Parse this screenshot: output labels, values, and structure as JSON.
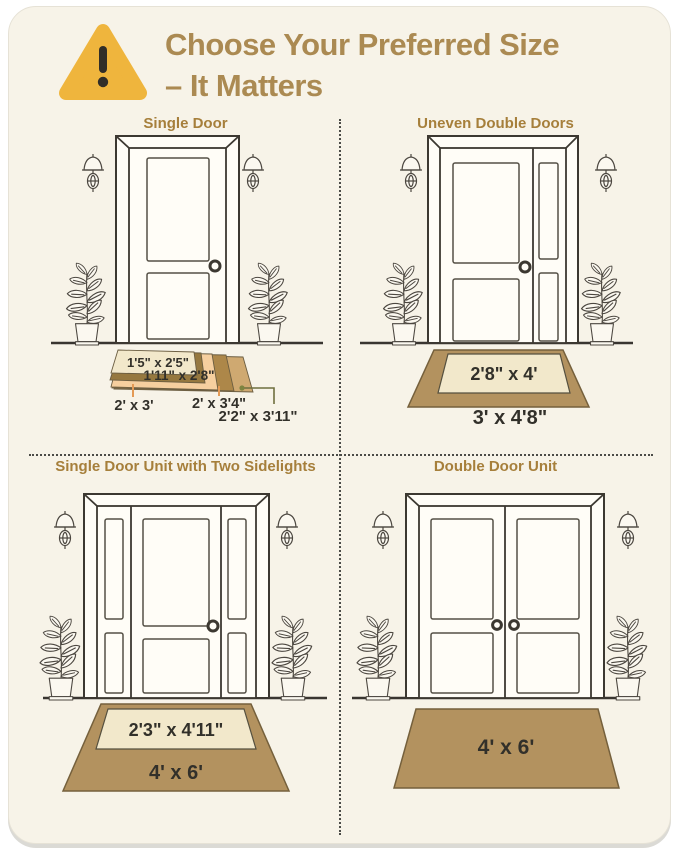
{
  "header": {
    "line1": "Choose Your Preferred Size",
    "line2": "– It Matters",
    "warning_icon": "exclamation-triangle"
  },
  "sections": {
    "q1": {
      "title": "Single Door",
      "mats": [
        "1'5\" x 2'5\"",
        "1'11\" x 2'8\"",
        "2' x 3'",
        "2' x 3'4\"",
        "2'2\" x 3'11\""
      ]
    },
    "q2": {
      "title": "Uneven Double Doors",
      "mats": [
        "2'8\" x 4'",
        "3' x 4'8\""
      ]
    },
    "q3": {
      "title": "Single Door Unit with Two Sidelights",
      "mats": [
        "2'3\" x 4'11\"",
        "4' x 6'"
      ]
    },
    "q4": {
      "title": "Double Door Unit",
      "mats": [
        "4' x 6'"
      ]
    }
  },
  "colors": {
    "card_background": "#f7f3e8",
    "title_text": "#ab8a52",
    "section_title_text": "#a67f3b",
    "warning_triangle": "#efb53d",
    "mat_tan": "#b3925f",
    "mat_cream": "#f2e8cb",
    "mat_olive": "#96783f",
    "mat_peach": "#f6cf9f",
    "mat_medium_brown": "#ad8749",
    "mat_light_tan": "#cfa971",
    "leader_orange": "#e49a55",
    "label_text": "#32302a"
  }
}
